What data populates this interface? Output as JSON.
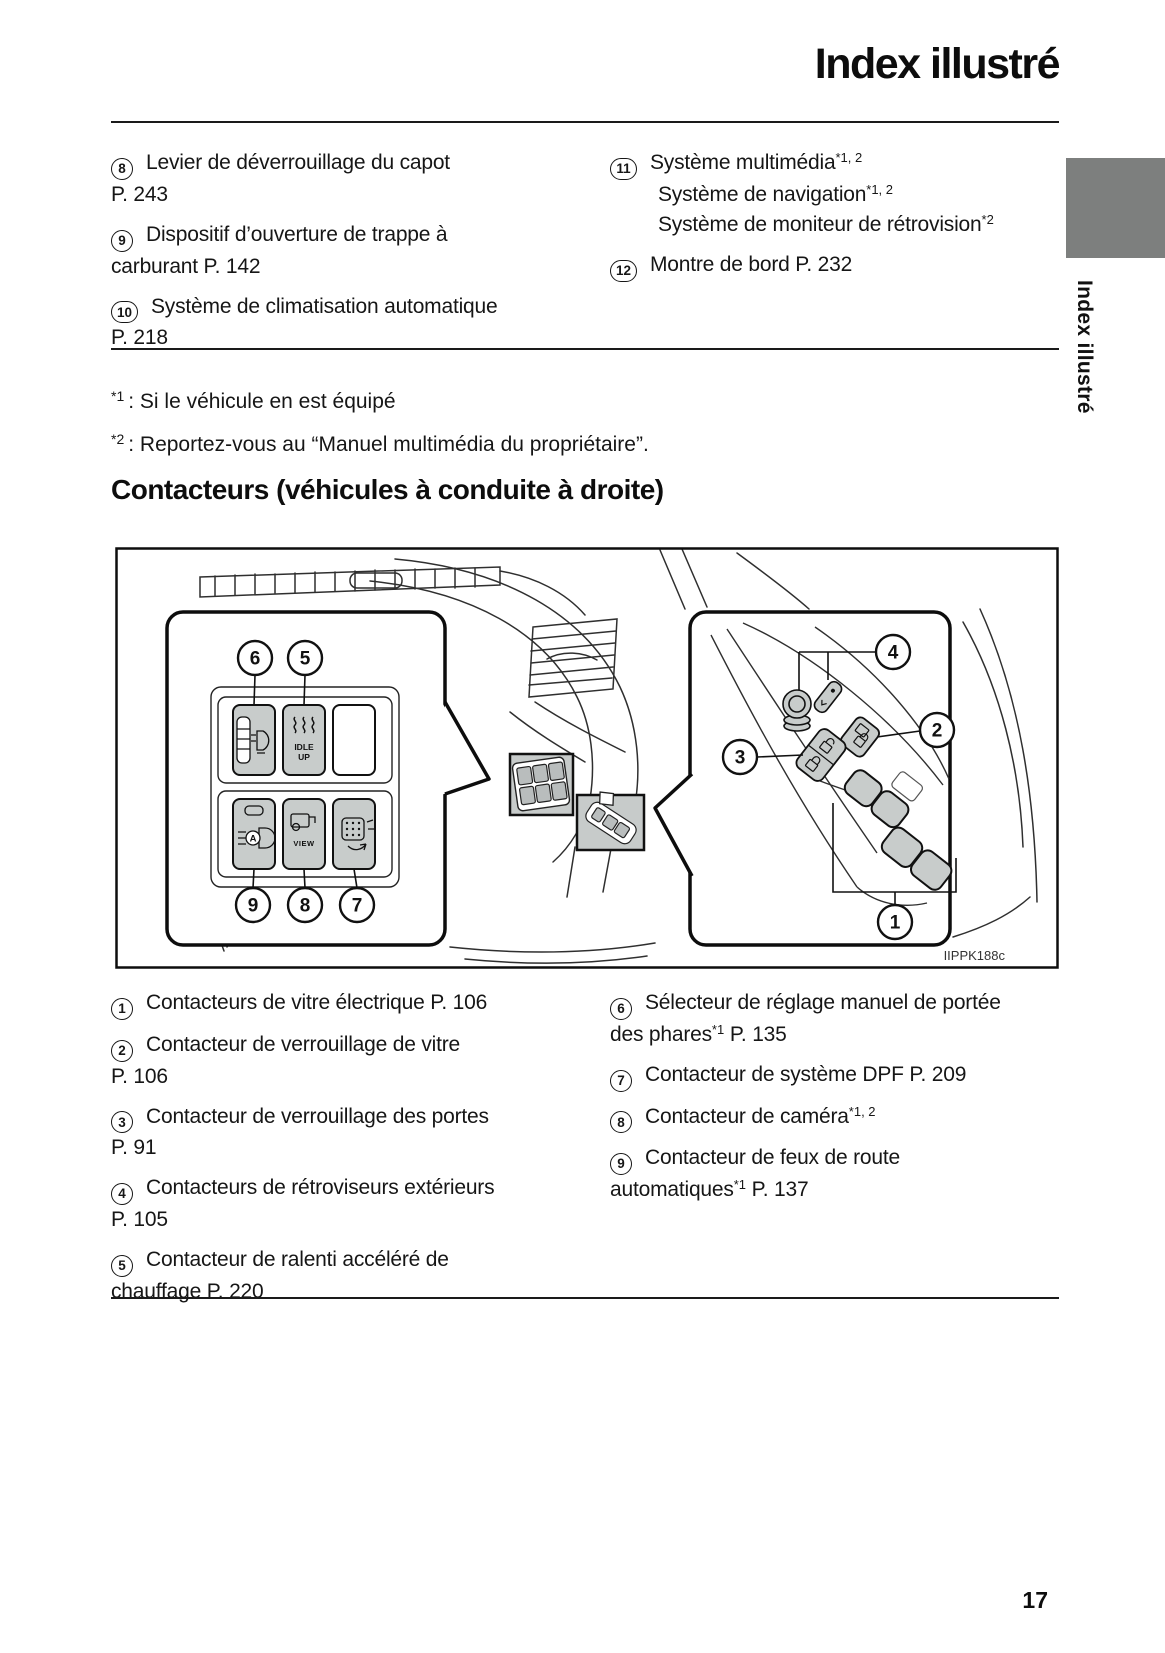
{
  "page": {
    "title": "Index illustré",
    "number": "17"
  },
  "side_tab": {
    "label": "Index illustré",
    "color": "#7d7f7e"
  },
  "top_list": {
    "left": [
      {
        "num": "8",
        "lines": [
          {
            "pre": "Levier de déverrouillage du capot"
          },
          {
            "pre": "P. 243"
          }
        ]
      },
      {
        "num": "9",
        "lines": [
          {
            "pre": "Dispositif d’ouverture de trappe à"
          },
          {
            "pre": "carburant P. 142"
          }
        ]
      },
      {
        "num": "10",
        "lines": [
          {
            "pre": "Système de climatisation automatique"
          },
          {
            "pre": "P. 218"
          }
        ]
      }
    ],
    "right": [
      {
        "num": "11",
        "lines": [
          {
            "pre": "Système multimédia",
            "sup": "*1, 2"
          },
          {
            "pre": "Système de navigation",
            "sup": "*1, 2"
          },
          {
            "pre": "Système de moniteur de rétrovision",
            "sup": "*2"
          }
        ]
      },
      {
        "num": "12",
        "lines": [
          {
            "pre": "Montre de bord P. 232"
          }
        ]
      }
    ]
  },
  "footnotes": [
    {
      "marker": "*1",
      "text": ": Si le véhicule en est équipé"
    },
    {
      "marker": "*2",
      "text": ": Reportez-vous au “Manuel multimédia du propriétaire”."
    }
  ],
  "section_heading": "Contacteurs (véhicules à conduite à droite)",
  "figure": {
    "code": "IIPPK188c",
    "callouts": {
      "c1": "1",
      "c2": "2",
      "c3": "3",
      "c4": "4",
      "c5": "5",
      "c6": "6",
      "c7": "7",
      "c8": "8",
      "c9": "9"
    },
    "labels": {
      "idle_line1": "IDLE",
      "idle_line2": "UP",
      "view": "VIEW",
      "auto_beam": "A"
    }
  },
  "bottom_list": {
    "left": [
      {
        "num": "1",
        "lines": [
          {
            "pre": "Contacteurs de vitre électrique P. 106"
          }
        ]
      },
      {
        "num": "2",
        "lines": [
          {
            "pre": "Contacteur de verrouillage de vitre"
          },
          {
            "pre": "P. 106"
          }
        ]
      },
      {
        "num": "3",
        "lines": [
          {
            "pre": "Contacteur de verrouillage des portes"
          },
          {
            "pre": "P. 91"
          }
        ]
      },
      {
        "num": "4",
        "lines": [
          {
            "pre": "Contacteurs de rétroviseurs extérieurs"
          },
          {
            "pre": "P. 105"
          }
        ]
      },
      {
        "num": "5",
        "lines": [
          {
            "pre": "Contacteur de ralenti accéléré de"
          },
          {
            "pre": "chauffage P. 220"
          }
        ]
      }
    ],
    "right": [
      {
        "num": "6",
        "lines": [
          {
            "pre": "Sélecteur de réglage manuel de portée"
          },
          {
            "pre": "des phares",
            "sup": "*1",
            "post": " P. 135"
          }
        ]
      },
      {
        "num": "7",
        "lines": [
          {
            "pre": "Contacteur de système DPF P. 209"
          }
        ]
      },
      {
        "num": "8",
        "lines": [
          {
            "pre": "Contacteur de caméra",
            "sup": "*1, 2"
          }
        ]
      },
      {
        "num": "9",
        "lines": [
          {
            "pre": "Contacteur de feux de route"
          },
          {
            "pre": "automatiques",
            "sup": "*1",
            "post": " P. 137"
          }
        ]
      }
    ]
  }
}
